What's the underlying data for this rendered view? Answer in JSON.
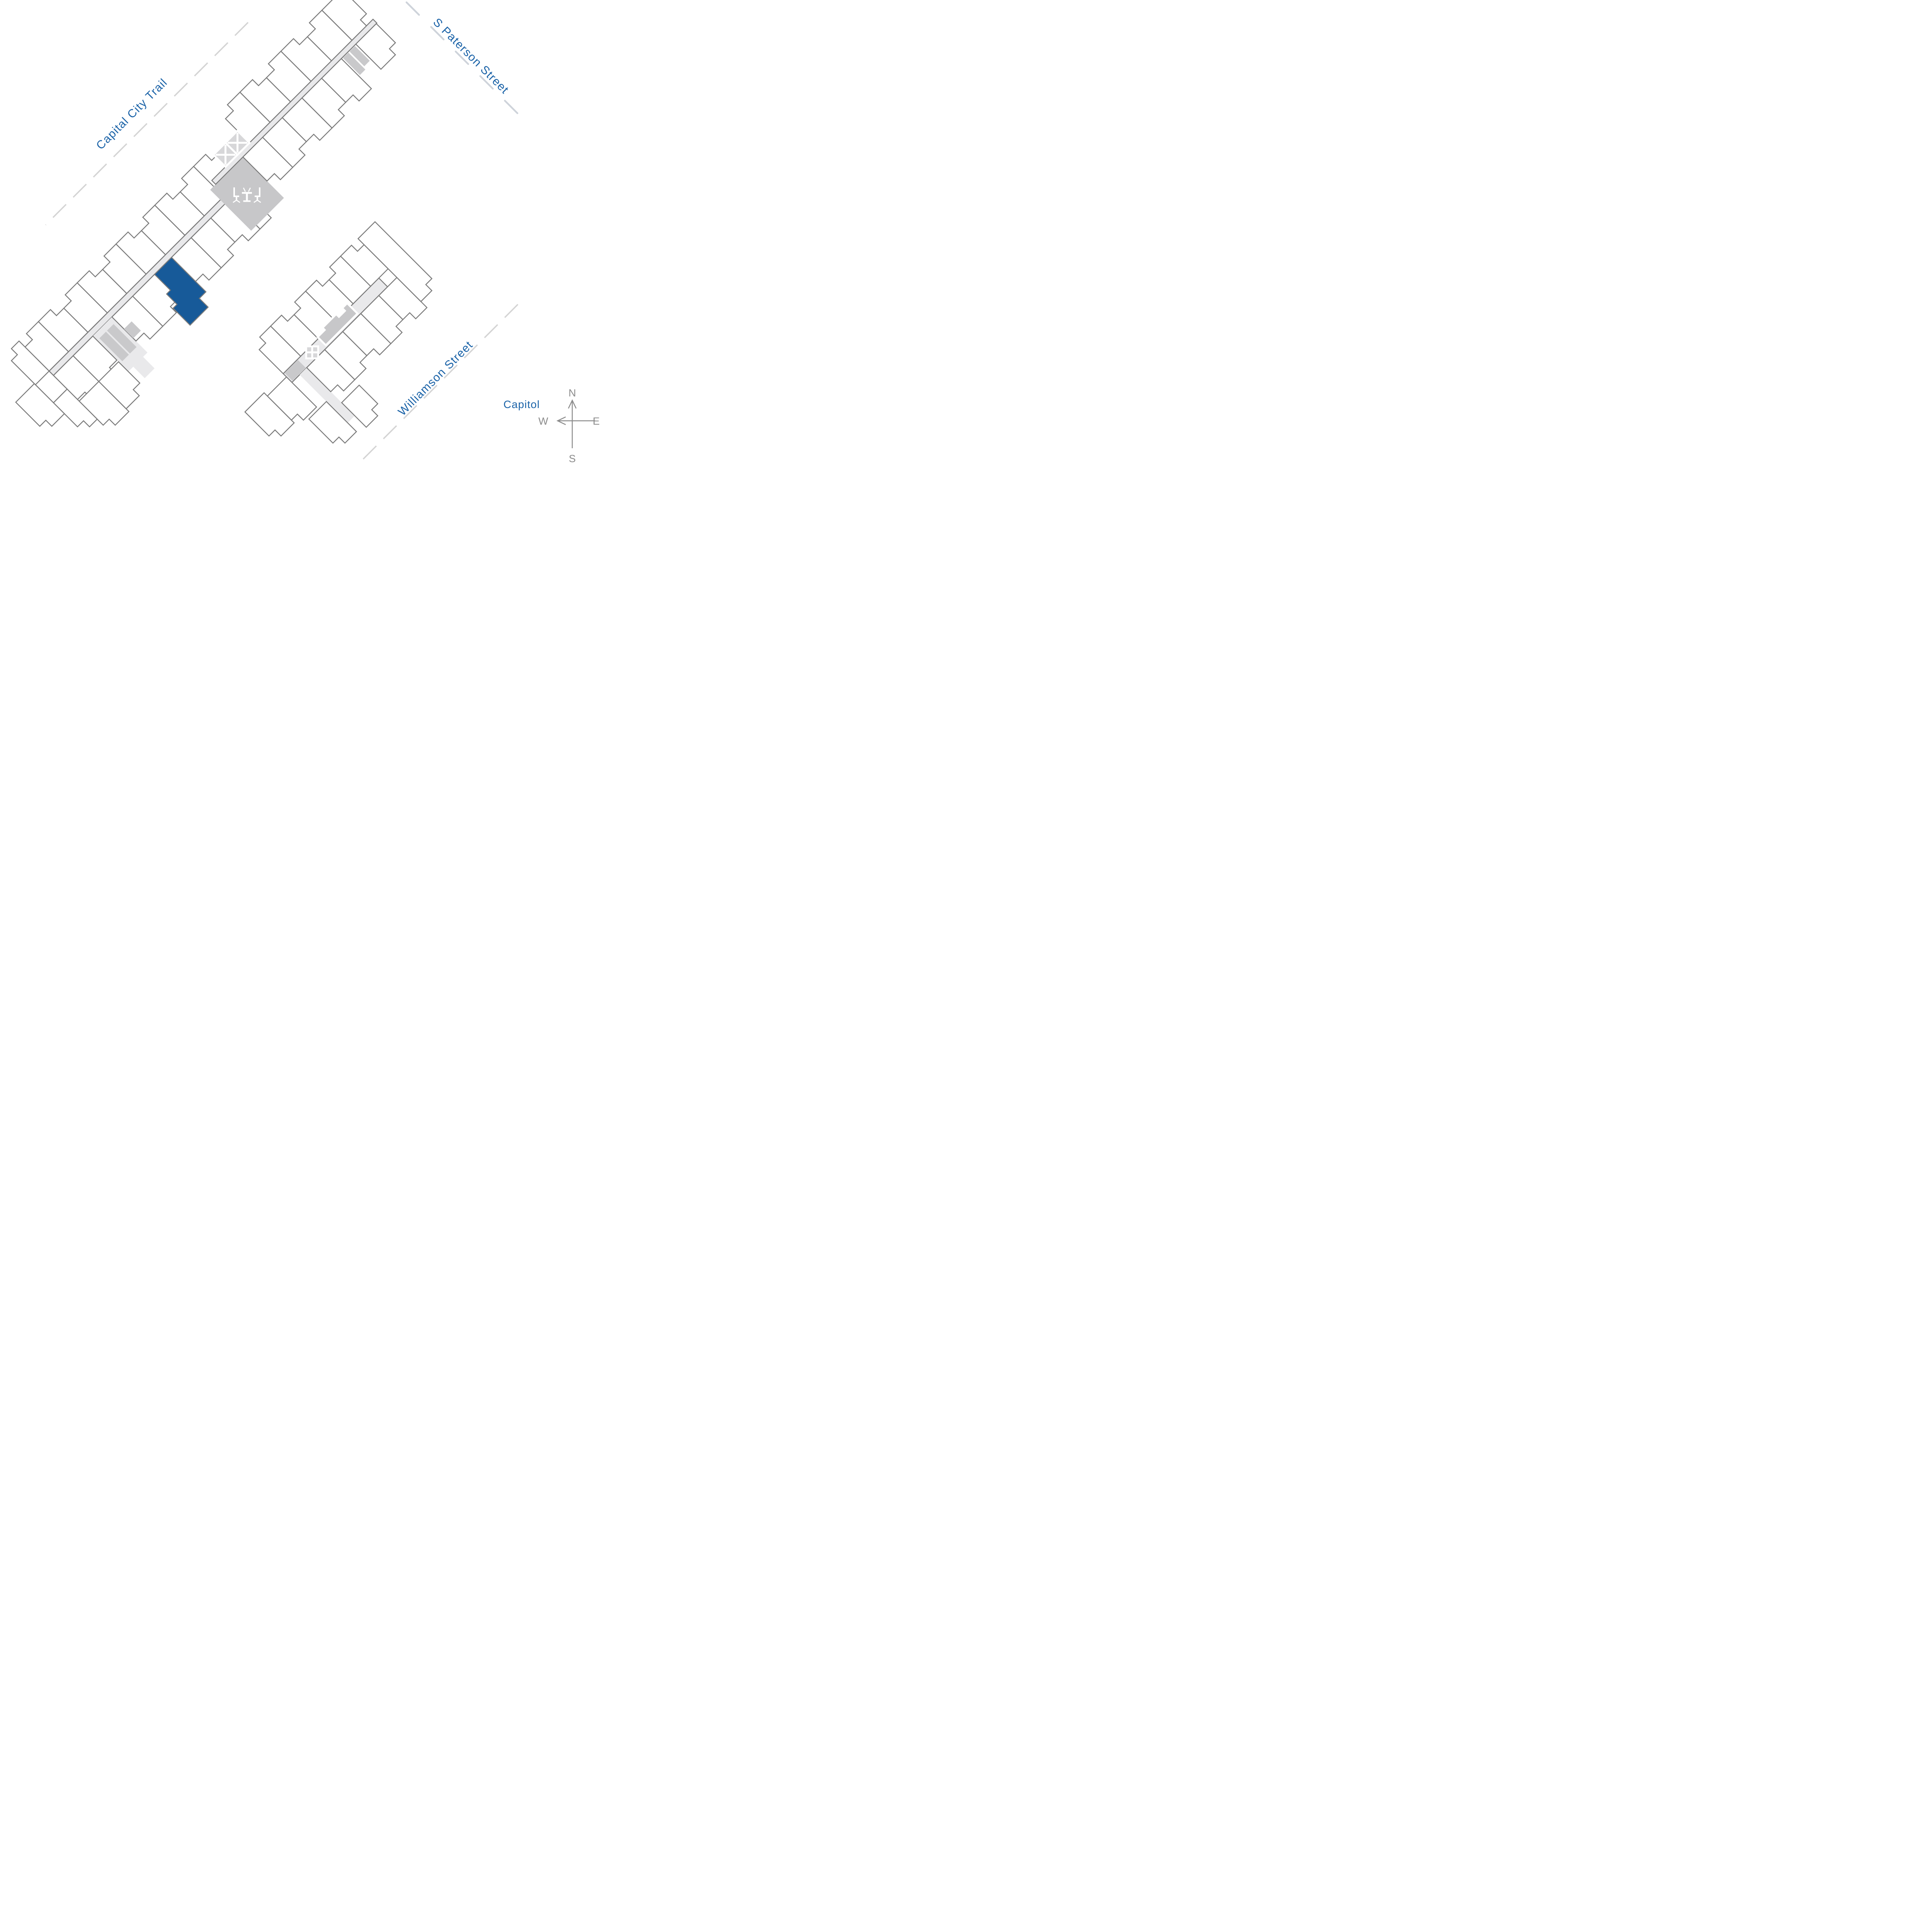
{
  "map": {
    "streets": {
      "capital_city_trail": "Capital City Trail",
      "s_paterson": "S Paterson Street",
      "williamson": "Williamson Street"
    },
    "landmarks": {
      "capitol": "Capitol"
    },
    "compass": {
      "north": "N",
      "east": "E",
      "south": "S",
      "west": "W"
    },
    "highlighted_unit": {
      "fill_color": "#175a99"
    },
    "icons": {
      "dining": "outdoor-dining-icon",
      "stairs": "stairs-x-icon",
      "compass": "compass-rose"
    },
    "colors": {
      "outline": "#7a7a7a",
      "unit_fill": "#ffffff",
      "corridor": "#e9e9eb",
      "amenity": "#c7c7c9",
      "elevator": "#c9c9cb",
      "stair_fill": "#d7d7d9",
      "highlight": "#175a99",
      "label_blue": "#1b63a8",
      "compass_gray": "#8c8c8c",
      "dash_gray": "#d4d4d4",
      "dash_blue_gray": "#ced3da"
    }
  }
}
